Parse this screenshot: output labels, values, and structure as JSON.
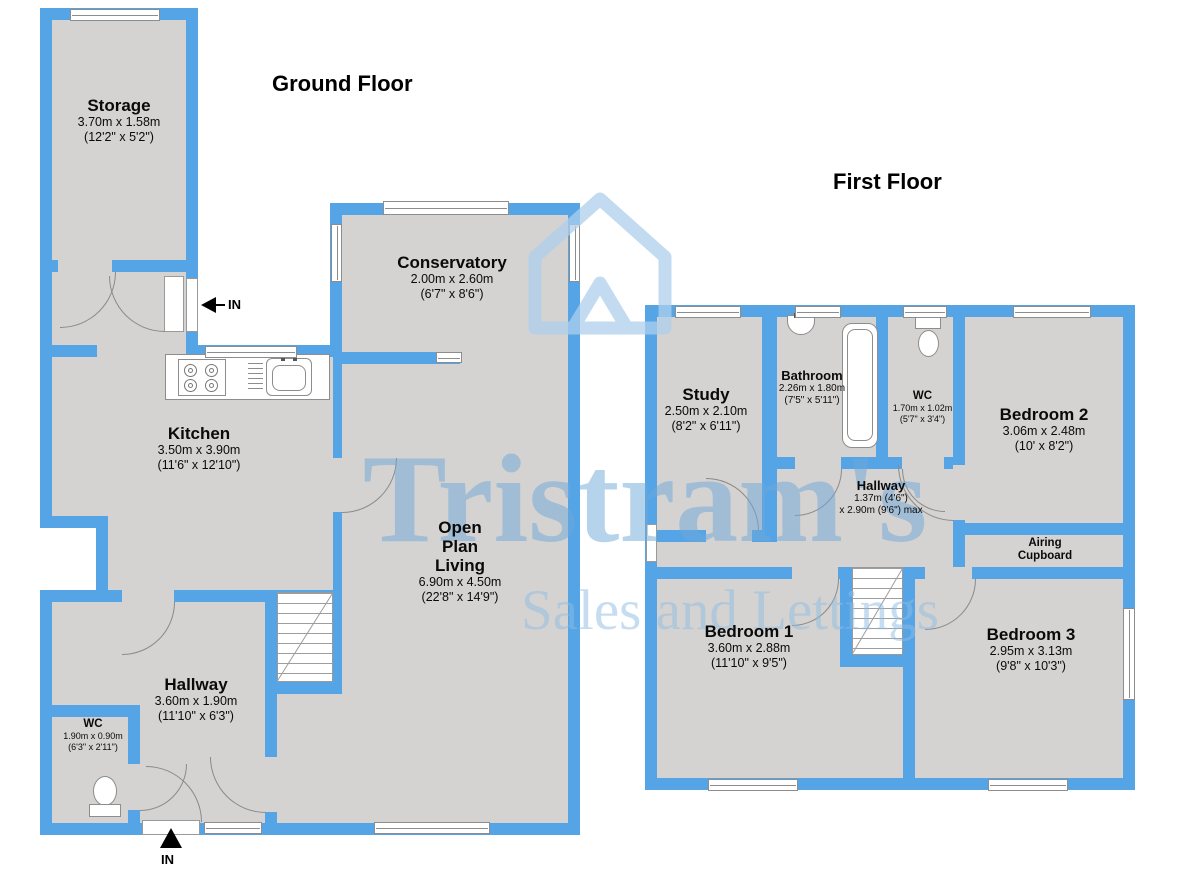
{
  "colors": {
    "wall": "#54a4e6",
    "room": "#d5d3d1",
    "watermark": "#aecfec"
  },
  "watermark": {
    "brand": "Tristram's",
    "tagline": "Sales and Lettings"
  },
  "floors": {
    "ground": {
      "title": "Ground Floor",
      "entrance_side": "IN",
      "entrance_front": "IN",
      "rooms": {
        "storage": {
          "name": "Storage",
          "metric": "3.70m x 1.58m",
          "imperial": "(12'2\" x 5'2\")"
        },
        "conservatory": {
          "name": "Conservatory",
          "metric": "2.00m x 2.60m",
          "imperial": "(6'7\" x 8'6\")"
        },
        "kitchen": {
          "name": "Kitchen",
          "metric": "3.50m x 3.90m",
          "imperial": "(11'6\" x 12'10\")"
        },
        "open_plan_living": {
          "name": "Open Plan Living",
          "metric": "6.90m x 4.50m",
          "imperial": "(22'8\" x 14'9\")"
        },
        "hallway": {
          "name": "Hallway",
          "metric": "3.60m x 1.90m",
          "imperial": "(11'10\" x 6'3\")"
        },
        "wc": {
          "name": "WC",
          "metric": "1.90m x 0.90m",
          "imperial": "(6'3\" x 2'11\")"
        }
      }
    },
    "first": {
      "title": "First Floor",
      "rooms": {
        "study": {
          "name": "Study",
          "metric": "2.50m x 2.10m",
          "imperial": "(8'2\" x 6'11\")"
        },
        "bathroom": {
          "name": "Bathroom",
          "metric": "2.26m x 1.80m",
          "imperial": "(7'5\" x 5'11\")"
        },
        "wc": {
          "name": "WC",
          "metric": "1.70m x 1.02m",
          "imperial": "(5'7\" x 3'4\")"
        },
        "bedroom2": {
          "name": "Bedroom 2",
          "metric": "3.06m x 2.48m",
          "imperial": "(10' x 8'2\")"
        },
        "hallway": {
          "name": "Hallway",
          "metric": "1.37m (4'6\")",
          "imperial": "x 2.90m (9'6\") max"
        },
        "airing_cupboard": {
          "name": "Airing Cupboard"
        },
        "bedroom1": {
          "name": "Bedroom 1",
          "metric": "3.60m x 2.88m",
          "imperial": "(11'10\" x 9'5\")"
        },
        "bedroom3": {
          "name": "Bedroom 3",
          "metric": "2.95m x 3.13m",
          "imperial": "(9'8\" x 10'3\")"
        }
      }
    }
  }
}
